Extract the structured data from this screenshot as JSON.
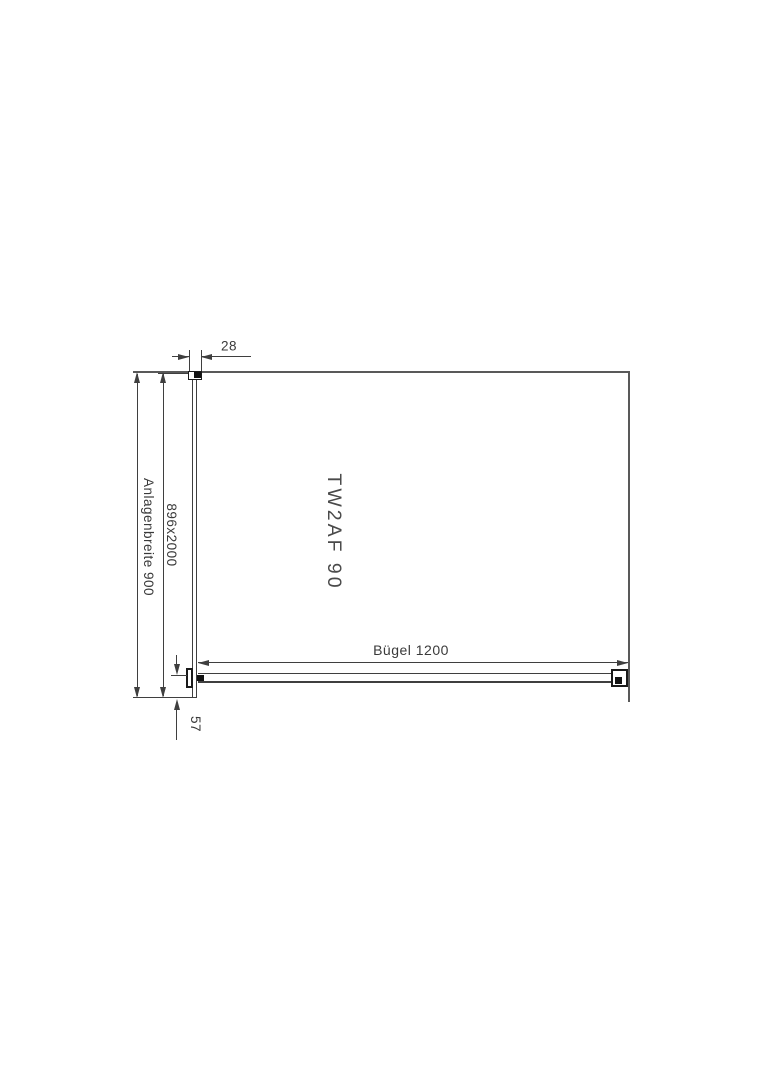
{
  "drawing": {
    "model_label": "TW2AF 90",
    "dimensions": {
      "top_width": "28",
      "glass_size": "896x2000",
      "installation_width": "Anlagenbreite 900",
      "bar_length": "Bügel 1200",
      "bottom_offset": "57"
    }
  },
  "colors": {
    "background": "#ffffff",
    "wall_line": "#595959",
    "dimension_line": "#3f3f3f",
    "text": "#3a3a3a",
    "bracket_fill": "#121212"
  }
}
